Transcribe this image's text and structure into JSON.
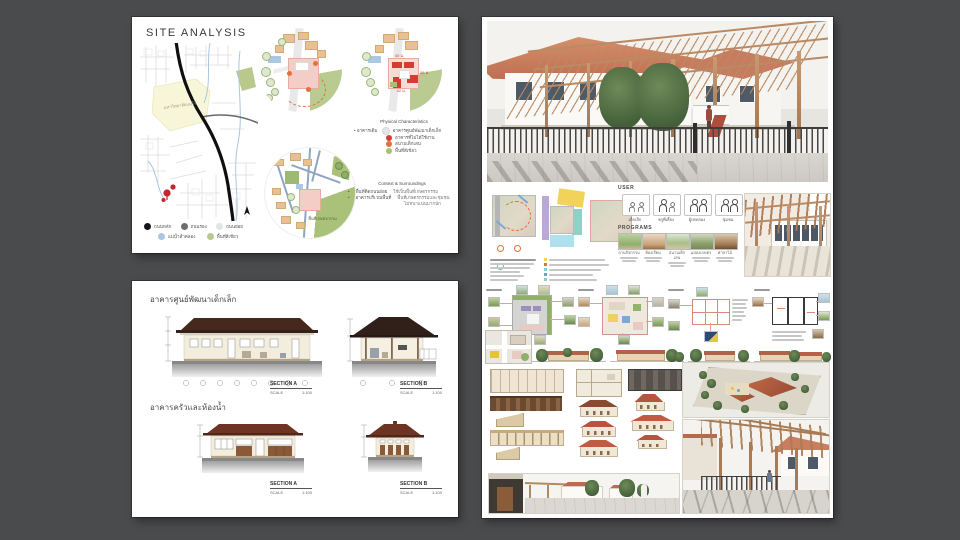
{
  "page": {
    "background": "#4a4b4d"
  },
  "site_board": {
    "title": "SITE ANALYSIS",
    "map": {
      "area_label": "มหาวิทยาลัยแม่โจ้",
      "legend": [
        {
          "color": "#151515",
          "label": "ถนนหลัก"
        },
        {
          "color": "#6d6e71",
          "label": "ถนนรอง"
        },
        {
          "color": "#e2e3e4",
          "label": "ถนนย่อย"
        },
        {
          "color": "#a9c6e2",
          "label": "แม่น้ำลำคลอง"
        },
        {
          "color": "#b8c98b",
          "label": "พื้นที่สีเขียว"
        }
      ]
    },
    "physical": {
      "title": "Physical Characteristics",
      "lead_label": "อาคารเดิม",
      "items": [
        {
          "color": "#e6e7e8",
          "label": "อาคารศูนย์พัฒนาเด็กเล็ก"
        },
        {
          "color": "#d93a32",
          "label": "อาคารที่ไม่ได้ใช้งาน"
        },
        {
          "color": "#e2713c",
          "label": "สนามเด็กเล่น"
        },
        {
          "color": "#a9bf72",
          "label": "พื้นที่สีเขียว"
        }
      ]
    },
    "context": {
      "title": "Context & Surroundings",
      "items": [
        {
          "label": "พื้นที่ติดถนนย่อย",
          "desc": "ใช้เป็นพื้นที่เกษตรกรรม"
        },
        {
          "label": "อาคารบริเวณพื้นที่",
          "desc": "พื้นที่เกษตรกรรมและชุมชน"
        }
      ],
      "note": "ไม่หนาแน่นมากนัก"
    },
    "farm_label": "พื้นที่เกษตรกรรม",
    "dims": {
      "top": "40 ม.",
      "right": "56 ม.",
      "bottom": "42 ม."
    }
  },
  "sections_board": {
    "building1_title": "อาคารศูนย์พัฒนาเด็กเล็ก",
    "building2_title": "อาคารครัวและห้องน้ำ",
    "label_section_a": "SECTION A",
    "label_section_b": "SECTION B",
    "scale_label": "SCALE",
    "scale_value": "1:100"
  },
  "design_board": {
    "user": {
      "title": "USER",
      "groups": [
        {
          "label": "เด็กเล็ก"
        },
        {
          "label": "ครูพี่เลี้ยง"
        },
        {
          "label": "ผู้ปกครอง"
        },
        {
          "label": "ชุมชน"
        }
      ]
    },
    "programs": {
      "title": "PROGRAMS",
      "items": [
        {
          "label": "ลานกิจกรรม"
        },
        {
          "label": "ห้องเรียน"
        },
        {
          "label": "สนามเด็กเล่น"
        },
        {
          "label": "แปลงเกษตร"
        },
        {
          "label": "ศาลาไม้"
        }
      ]
    },
    "colors": {
      "roof": "#c97e62",
      "wood": "#b98a64",
      "fence": "#454545",
      "zone_yellow": "#f2d35a",
      "zone_purple": "#b9a8d8",
      "zone_teal": "#8fd0c8",
      "zone_blue": "#aee0ee"
    }
  }
}
